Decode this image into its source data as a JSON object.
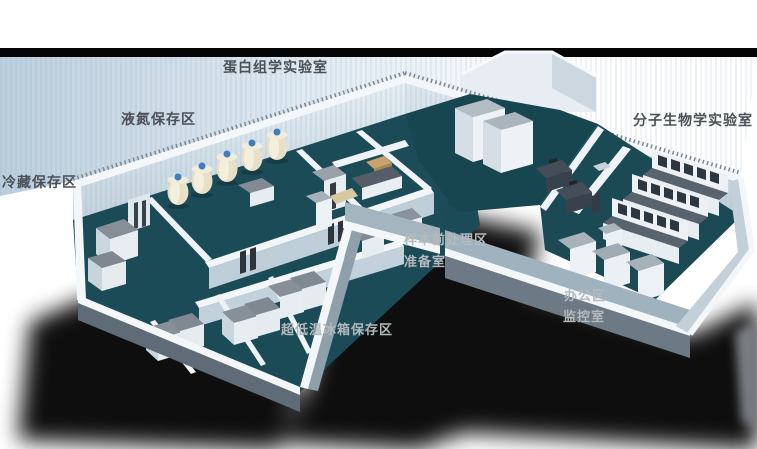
{
  "scene": {
    "description": "实验室三维布局效果图",
    "view": "isometric cutaway floor plan of an L-shaped laboratory",
    "background": "#ffffff"
  },
  "colors": {
    "floor": "#1b4b56",
    "floor_dark": "#174650",
    "wall_rim": "#f3f7fa",
    "wall_shade": "#c6d4de",
    "haze": "#bccfdd",
    "shadow": "#000000",
    "label_dark": "#4b5157",
    "label_light": "#b4b9bd",
    "dewar_body": "#e7dfc6",
    "dewar_cap": "#3f7ec0",
    "freezer_top": "#868f98",
    "bench_top": "#59636d"
  },
  "areas": [
    {
      "id": "proteomics-lab",
      "label": "蛋白组学实验室",
      "tone": "dark"
    },
    {
      "id": "liquid-nitrogen-storage",
      "label": "液氮保存区",
      "tone": "dark"
    },
    {
      "id": "cold-storage",
      "label": "冷藏保存区",
      "tone": "dark"
    },
    {
      "id": "molecular-biology-lab",
      "label": "分子生物学实验室",
      "tone": "dark"
    },
    {
      "id": "sample-pretreatment",
      "label": "样本前处理区",
      "tone": "light"
    },
    {
      "id": "preparation-room",
      "label": "准备室",
      "tone": "light"
    },
    {
      "id": "office-area",
      "label": "办公区",
      "tone": "light"
    },
    {
      "id": "monitoring-room",
      "label": "监控室",
      "tone": "light"
    },
    {
      "id": "ult-freezer-storage",
      "label": "超低温冰箱保存区",
      "tone": "light"
    }
  ]
}
